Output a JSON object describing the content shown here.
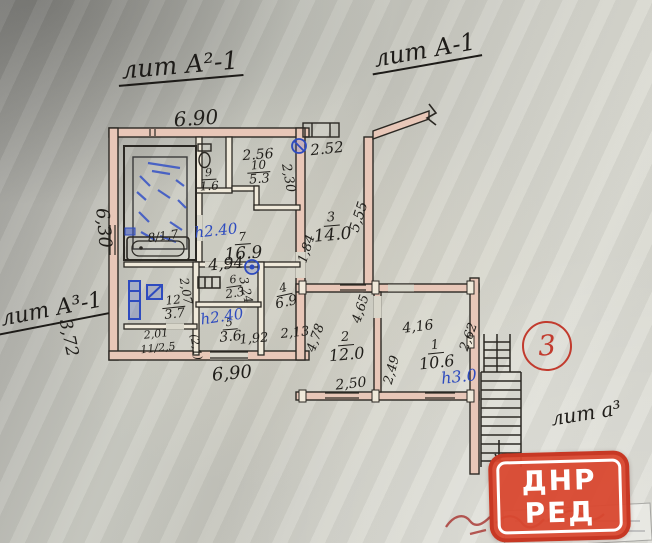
{
  "titles": {
    "lit_a2": "лит А²-1",
    "lit_a": "лит А-1",
    "lit_a3": "лит А³-1",
    "lit_a3_stairs": "лит а³"
  },
  "marker": {
    "number": "3"
  },
  "rooms": {
    "r9": {
      "n": "9",
      "a": "1.6"
    },
    "r10": {
      "n": "10",
      "a": "5.3"
    },
    "r7": {
      "n": "7",
      "a": "16.9"
    },
    "r3": {
      "n": "3",
      "a": "14.0"
    },
    "r12": {
      "n": "12",
      "a": "3.7"
    },
    "r6": {
      "n": "6",
      "a": "2.3"
    },
    "r4": {
      "n": "4",
      "a": "6.9"
    },
    "r5": {
      "n": "5",
      "a": "3.6"
    },
    "r11": {
      "combined": "11/2,5"
    },
    "r8": {
      "combined": "8/1,7"
    },
    "r2": {
      "n": "2",
      "a": "12.0"
    },
    "r1": {
      "n": "1",
      "a": "10.6"
    }
  },
  "dimensions": {
    "top": "6.90",
    "left": "6,30",
    "left_lower": "3,72",
    "bottom": "6,90",
    "w256": "2.56",
    "w230": "2,30",
    "w252": "2.52",
    "w555": "5,55",
    "w184": "1,84",
    "w494": "4,94",
    "w207": "2,07",
    "w324": "3,24",
    "w201": "2,01",
    "w21": "(2,1)",
    "w192": "1,92",
    "w213": "2,13",
    "w478": "4,78",
    "w465": "4,65",
    "w416": "4,16",
    "w262": "2,62",
    "w249": "2,49",
    "w250": "2,50"
  },
  "heights": {
    "h_room7": "h2.40",
    "h_room5": "h2.40",
    "h_room1": "h3.0"
  },
  "watermark": {
    "line1": "ДНР",
    "line2": "РЕД"
  },
  "colors": {
    "ink": "#211f1b",
    "blue": "#2e4bbf",
    "red": "#c23b2e",
    "wall_fill": "#e8c7b8",
    "badge": "#d9482f"
  }
}
